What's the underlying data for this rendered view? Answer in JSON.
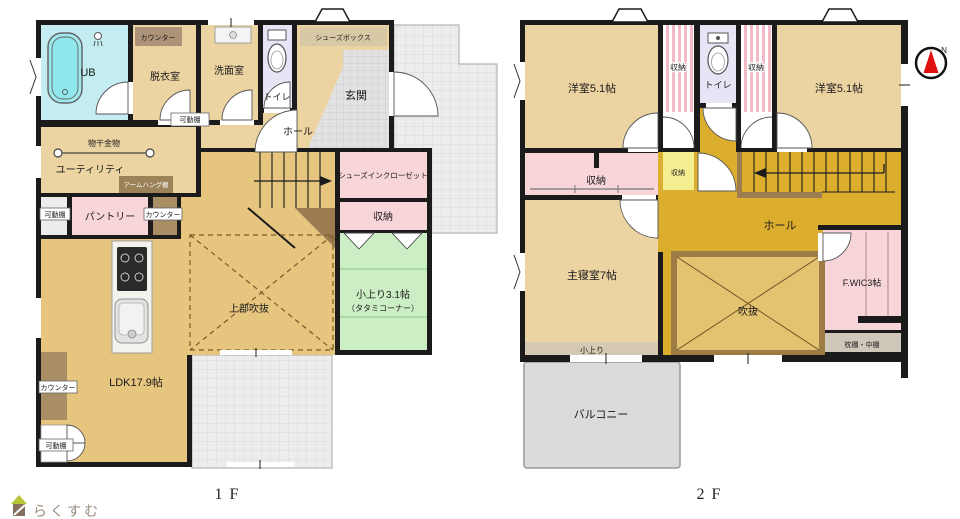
{
  "floor1": {
    "counter_bath": "カウンター",
    "ub": "UB",
    "dressing": "脱衣室",
    "washroom": "洗面室",
    "toilet": "トイレ",
    "shoe_box": "シューズボックス",
    "entrance": "玄関",
    "shelf_top": "可動棚",
    "hall": "ホール",
    "laundry_hanger": "物干金物",
    "utility": "ユーティリティ",
    "arm_hang_shelf": "アームハング棚",
    "shelf_pantry": "可動棚",
    "pantry": "パントリー",
    "counter_pantry": "カウンター",
    "shoes_in_closet": "シューズインクローゼット",
    "storage": "収納",
    "tatami_line1": "小上り3.1帖",
    "tatami_line2": "（タタミコーナー）",
    "void_above": "上部吹抜",
    "ldk": "LDK17.9帖",
    "counter_wall": "カウンター",
    "shelf_bottom": "可動棚",
    "floor_label": "1F"
  },
  "floor2": {
    "west_room_left": "洋室5.1帖",
    "closet_top_left": "収納",
    "toilet": "トイレ",
    "closet_top_right": "収納",
    "west_room_right": "洋室5.1帖",
    "closet_mid": "収納",
    "closet_yellow": "収納",
    "hall": "ホール",
    "master_bedroom": "主寝室7帖",
    "step": "小上り",
    "void": "吹抜",
    "fwic": "F.WIC3帖",
    "pillow_shelf": "枕棚・中棚",
    "balcony": "バルコニー",
    "floor_label": "2F"
  },
  "misc": {
    "logo": "らくすむ",
    "compass_n": "N"
  },
  "colors": {
    "wall": "#1b1b1b",
    "room_beige": "#ecd3a2",
    "ldk_gold": "#e6c57f",
    "hall_mustard": "#dcae2e",
    "void_gold": "#e4c370",
    "void_frame_brown": "#9c7c44",
    "closet_pink": "#f8d5d8",
    "stripe_pink": "#f3bac8",
    "storage_yellow": "#f6ef92",
    "tatami_green": "#cceec5",
    "bath_cyan": "#c4edf2",
    "tub_cyan": "#8fe7ec",
    "toilet_lavender": "#e5e5f6",
    "counter_brown": "#a98e66",
    "balcony_gray": "#dbdbdb",
    "compass_red": "#e01010"
  }
}
